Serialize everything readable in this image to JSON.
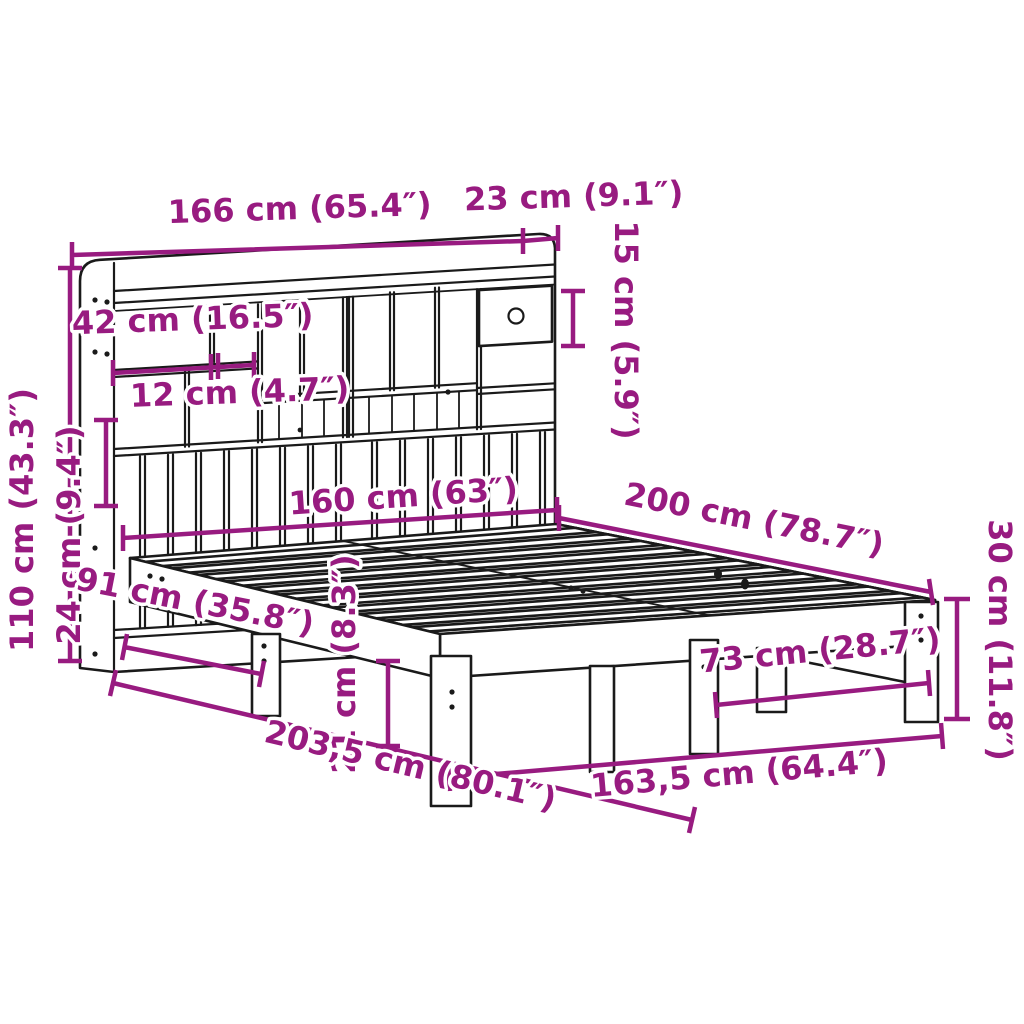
{
  "diagram": {
    "type": "product-dimension-diagram",
    "subject": "bookcase-bed-with-shelf-headboard",
    "colors": {
      "dimension": "#981B80",
      "outline": "#1A1A1A",
      "background": "#FFFFFF"
    },
    "dimensions": {
      "headboard_width": "166 cm (65.4″)",
      "headboard_depth": "23 cm (9.1″)",
      "compartment_height": "15 cm (5.9″)",
      "shelf_width": "42 cm (16.5″)",
      "shelf_gap": "12 cm (4.7″)",
      "headboard_height": "110 cm (43.3″)",
      "slat_panel_height": "24 cm (9.4″)",
      "bed_width": "160 cm (63″)",
      "bed_length": "200 cm (78.7″)",
      "frame_height": "30 cm (11.8″)",
      "leg_spacing_side": "91 cm (35.8″)",
      "underbed_clearance": "21 cm (8.3″)",
      "total_length": "203,5 cm (80.1″)",
      "leg_spacing_foot": "73 cm (28.7″)",
      "frame_length": "163,5 cm (64.4″)"
    }
  }
}
